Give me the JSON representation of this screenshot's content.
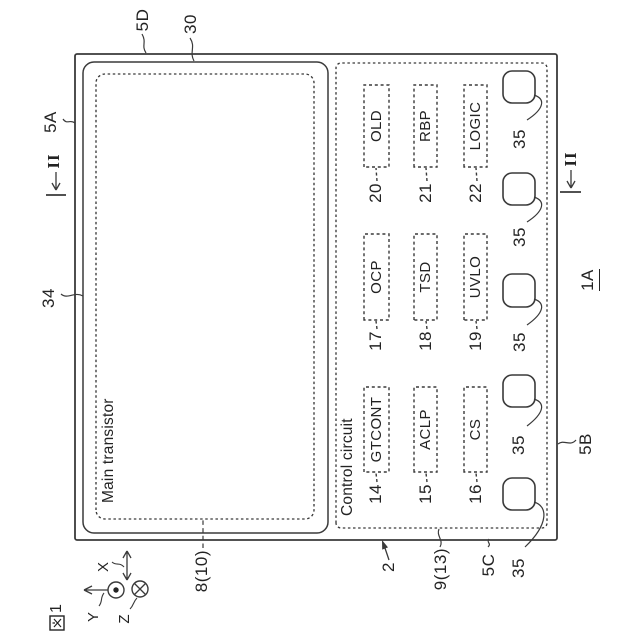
{
  "figure": {
    "label": "図1",
    "label_digit": "1",
    "device_ref": "1A"
  },
  "axes": {
    "x": "X",
    "y": "Y",
    "z": "Z"
  },
  "section_marker": {
    "label": "II"
  },
  "chip": {
    "ref": "2",
    "side_top": "5A",
    "side_bottom": "5B",
    "side_left": "5C",
    "side_right": "5D",
    "outline_30": "30",
    "outline_34": "34"
  },
  "main_transistor": {
    "title": "Main transistor",
    "ref": "8(10)"
  },
  "control_circuit": {
    "title": "Control circuit",
    "ref": "9(13)",
    "blocks": [
      {
        "label": "GTCONT",
        "ref": "14"
      },
      {
        "label": "OCP",
        "ref": "17"
      },
      {
        "label": "OLD",
        "ref": "20"
      },
      {
        "label": "ACLP",
        "ref": "15"
      },
      {
        "label": "TSD",
        "ref": "18"
      },
      {
        "label": "RBP",
        "ref": "21"
      },
      {
        "label": "CS",
        "ref": "16"
      },
      {
        "label": "UVLO",
        "ref": "19"
      },
      {
        "label": "LOGIC",
        "ref": "22"
      }
    ],
    "pads": [
      {
        "ref": "35"
      },
      {
        "ref": "35"
      },
      {
        "ref": "35"
      },
      {
        "ref": "35"
      },
      {
        "ref": "35"
      }
    ]
  },
  "colors": {
    "line": "#3a3a3a",
    "text": "#232323",
    "background": "#ffffff"
  }
}
